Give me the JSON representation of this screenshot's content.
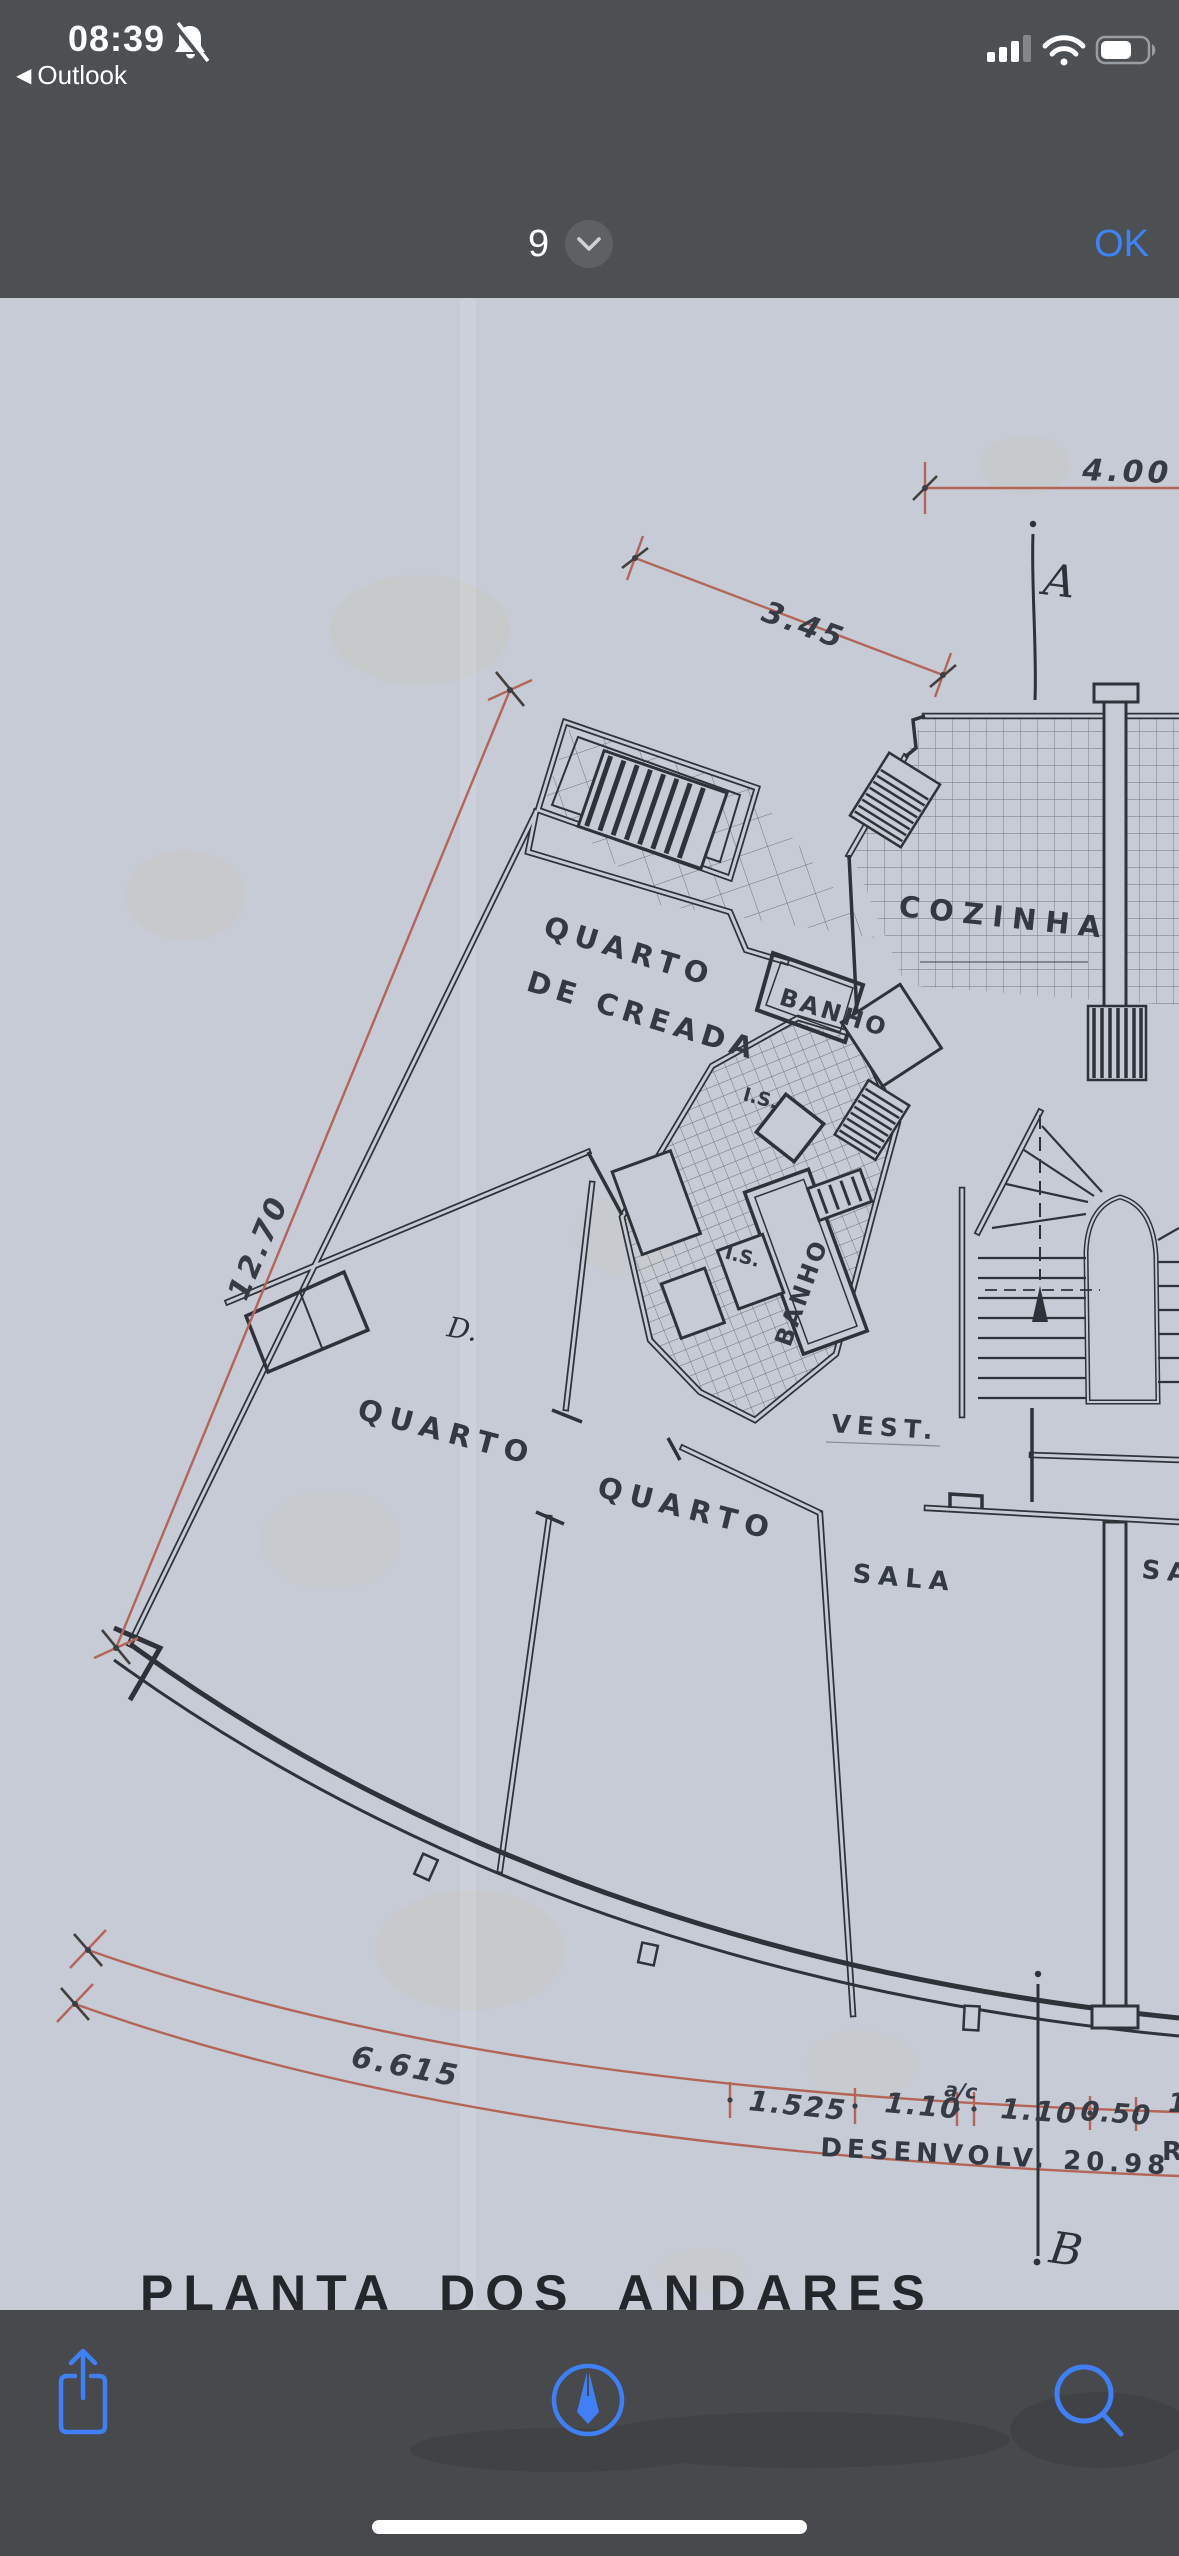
{
  "accent_color": "#3b7cf6",
  "status_bar": {
    "time": "08:39",
    "back_app_label": "Outlook"
  },
  "icons": {
    "back_arrow": "◀"
  },
  "nav_bar": {
    "page_indicator": "9",
    "confirm_label": "OK"
  },
  "floor_plan": {
    "title": "PLANTA  DOS  ANDARES",
    "colors": {
      "paper": "#c6cbd5",
      "ink": "#2e333a",
      "dimension_red": "#b4655a"
    },
    "rooms": {
      "maid_room_line1": "QUARTO",
      "maid_room_line2": "DE CREADA",
      "bath_upper": "BANHO",
      "bath_lower": "BANHO",
      "wc_upper": "I.S.",
      "wc_lower": "I.S.",
      "kitchen": "COZINHA",
      "vestibule": "VEST.",
      "closet": "D.",
      "bedroom_left": "QUARTO",
      "bedroom_mid": "QUARTO",
      "living": "SALA",
      "living_partial": "SA"
    },
    "dimensions": {
      "top": "4.00",
      "upper_diagonal": "3.45",
      "left_side": "12.70",
      "bottom_curve": "6.615",
      "chain": [
        "1.525",
        "1.10",
        "1.10",
        "0.50"
      ],
      "chain_note": "a/c",
      "chain_partial": "1",
      "development": "DESENVOLV.  20.98",
      "development_partial": "R"
    },
    "sections": {
      "a": "A",
      "b": "B"
    }
  }
}
